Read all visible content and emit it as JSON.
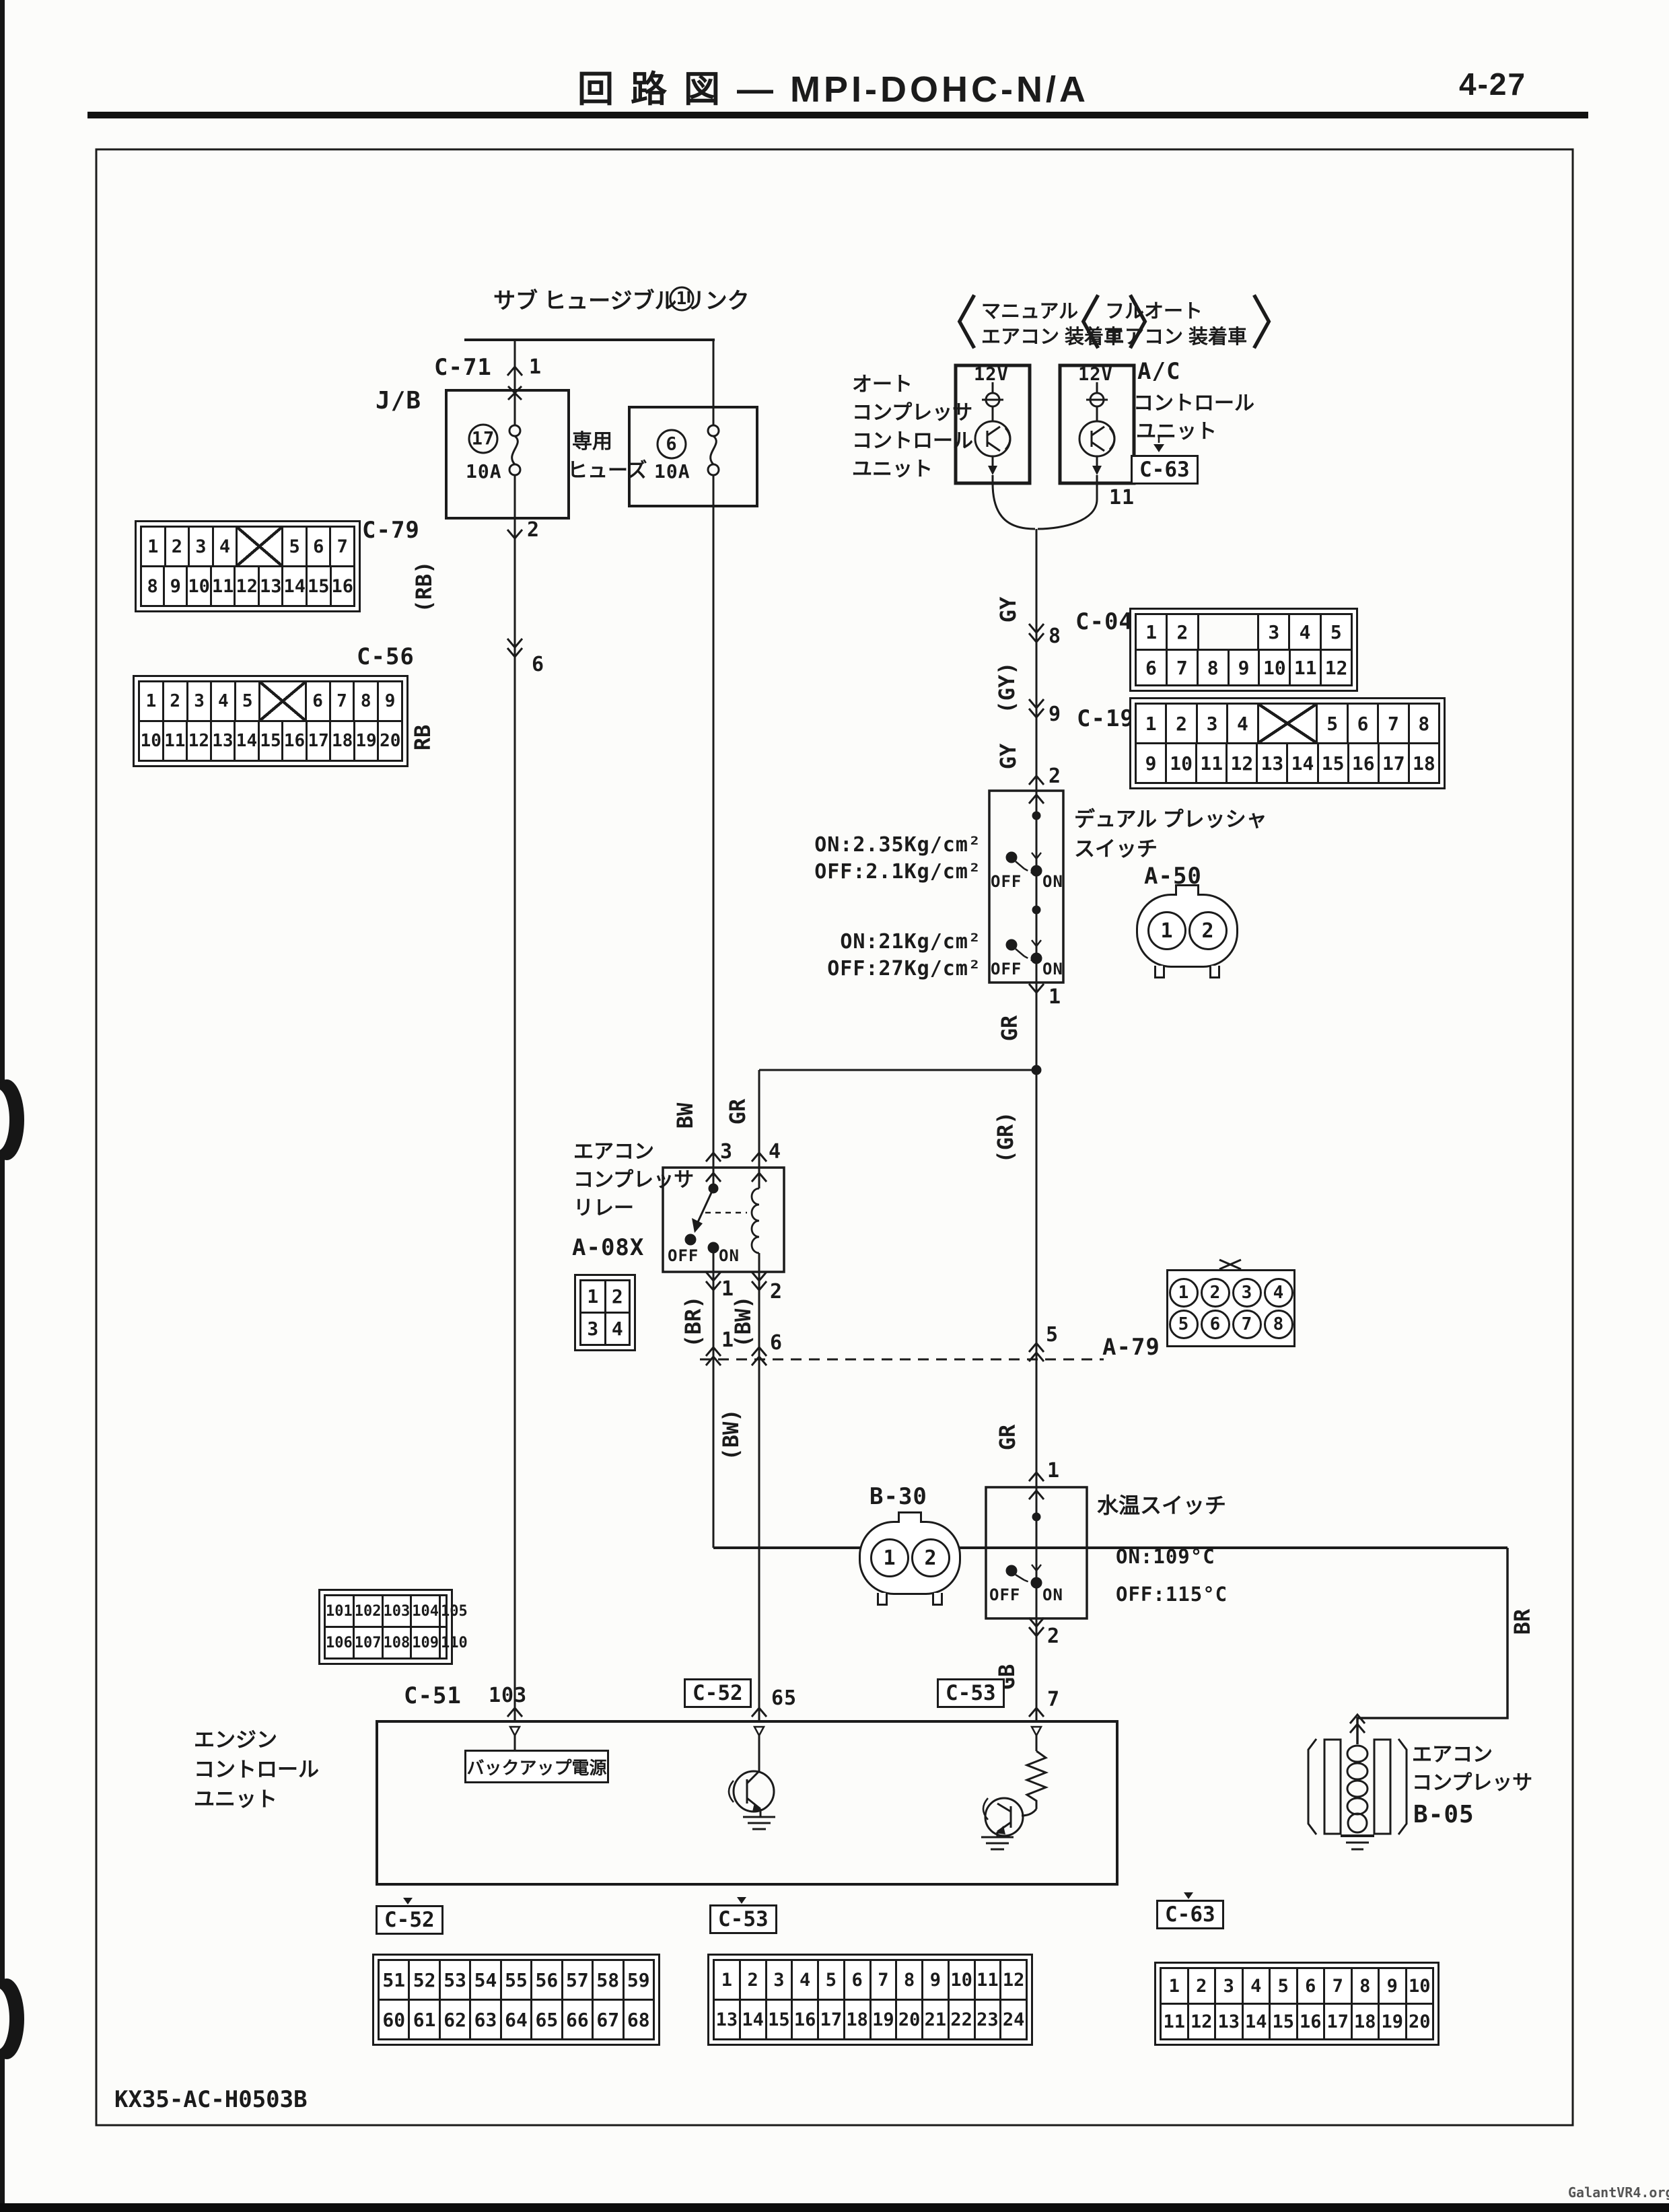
{
  "page": {
    "title": "回 路 図 — MPI-DOHC-N/A",
    "page_no": "4-27",
    "doc_code": "KX35-AC-H0503B",
    "watermark": "GalantVR4.org"
  },
  "power": {
    "fusible_link": "サブ ヒュージブル リンク",
    "link_no": "1",
    "jb": "J/B",
    "c71": "C-71",
    "c71_pin": "1",
    "fuse1_no": "17",
    "fuse1_amp": "10A",
    "dedicated_fuse_1": "専用",
    "dedicated_fuse_2": "ヒューズ",
    "fuse2_no": "6",
    "fuse2_amp": "10A",
    "c79": "C-79",
    "c79_pin": "2",
    "c56": "C-56",
    "c56_pin": "6"
  },
  "units": {
    "manual_tag_1": "マニュアル",
    "manual_tag_2": "エアコン 装着車",
    "auto_tag_1": "フルオート",
    "auto_tag_2": "エアコン 装着車",
    "v12_left": "12V",
    "v12_right": "12V",
    "left_name_1": "オート",
    "left_name_2": "コンプレッサ",
    "left_name_3": "コントロール",
    "left_name_4": "ユニット",
    "right_name_1": "A/C",
    "right_name_2": "コントロール",
    "right_name_3": "ユニット",
    "c63_top": "C-63",
    "pin11": "11"
  },
  "pressure_switch": {
    "name_1": "デュアル プレッシャ",
    "name_2": "スイッチ",
    "conn": "A-50",
    "hi_on": "ON:2.35Kg/cm²",
    "hi_off": "OFF:2.1Kg/cm²",
    "lo_on": "ON:21Kg/cm²",
    "lo_off": "OFF:27Kg/cm²",
    "sw1_off": "OFF",
    "sw1_on": "ON",
    "sw2_off": "OFF",
    "sw2_on": "ON",
    "pin_in": "2",
    "pin_out": "1"
  },
  "relay": {
    "name_1": "エアコン",
    "name_2": "コンプレッサ",
    "name_3": "リレー",
    "conn": "A-08X",
    "off": "OFF",
    "on": "ON",
    "pin3": "3",
    "pin4": "4",
    "pin1": "1",
    "pin2": "2"
  },
  "a79": {
    "label": "A-79",
    "pin1": "1",
    "pin6": "6",
    "pin5": "5"
  },
  "water_switch": {
    "conn": "B-30",
    "name": "水温スイッチ",
    "on_temp": "ON:109°C",
    "off_temp": "OFF:115°C",
    "sw_off": "OFF",
    "sw_on": "ON",
    "pin_in": "1",
    "pin_out": "2"
  },
  "ecu": {
    "name_1": "エンジン",
    "name_2": "コントロール",
    "name_3": "ユニット",
    "backup": "バックアップ電源",
    "c51": "C-51",
    "pin103": "103",
    "pin65": "65",
    "pin7": "7"
  },
  "compressor": {
    "name_1": "エアコン",
    "name_2": "コンプレッサ",
    "conn": "B-05"
  },
  "wires": {
    "rb_p": "(RB)",
    "rb": "RB",
    "bw": "BW",
    "gr_relay": "GR",
    "gy1": "GY",
    "gy_pin8": "8",
    "gy_p": "(GY)",
    "gy_pin9": "9",
    "gy2": "GY",
    "gr1": "GR",
    "gr_p": "(GR)",
    "br_p": "(BR)",
    "bw_p": "(BW)",
    "bw_p2": "(BW)",
    "gr2": "GR",
    "gb": "GB",
    "br": "BR"
  },
  "connectors": {
    "c79": {
      "label": "C-79",
      "rows": [
        [
          "1",
          "2",
          "3",
          "4",
          "X",
          "5",
          "6",
          "7"
        ],
        [
          "8",
          "9",
          "10",
          "11",
          "12",
          "13",
          "14",
          "15",
          "16"
        ]
      ]
    },
    "c56": {
      "label": "C-56",
      "rows": [
        [
          "1",
          "2",
          "3",
          "4",
          "5",
          "X",
          "6",
          "7",
          "8",
          "9"
        ],
        [
          "10",
          "11",
          "12",
          "13",
          "14",
          "15",
          "16",
          "17",
          "18",
          "19",
          "20"
        ]
      ]
    },
    "c04": {
      "label": "C-04",
      "rows": [
        [
          "1",
          "2",
          "GAP",
          "3",
          "4",
          "5"
        ],
        [
          "6",
          "7",
          "8",
          "9",
          "10",
          "11",
          "12"
        ]
      ]
    },
    "c19": {
      "label": "C-19",
      "rows": [
        [
          "1",
          "2",
          "3",
          "4",
          "X",
          "5",
          "6",
          "7",
          "8"
        ],
        [
          "9",
          "10",
          "11",
          "12",
          "13",
          "14",
          "15",
          "16",
          "17",
          "18"
        ]
      ]
    },
    "c51": {
      "label": "C-51",
      "rows": [
        [
          "101",
          "102",
          "103",
          "104",
          "105"
        ],
        [
          "106",
          "107",
          "108",
          "109",
          "110"
        ]
      ]
    },
    "a08x": {
      "label": "A-08X",
      "rows": [
        [
          "1",
          "2"
        ],
        [
          "3",
          "4"
        ]
      ]
    },
    "a79c": {
      "label": "A-79",
      "rows": [
        [
          "1",
          "2",
          "3",
          "4"
        ],
        [
          "5",
          "6",
          "7",
          "8"
        ]
      ]
    },
    "a50c": {
      "label": "A-50",
      "rows": [
        [
          "1",
          "2"
        ]
      ]
    },
    "b30c": {
      "label": "B-30",
      "rows": [
        [
          "1",
          "2"
        ]
      ]
    },
    "c52b": {
      "label": "C-52",
      "rows": [
        [
          "51",
          "52",
          "53",
          "54",
          "55",
          "56",
          "57",
          "58",
          "59"
        ],
        [
          "60",
          "61",
          "62",
          "63",
          "64",
          "65",
          "66",
          "67",
          "68"
        ]
      ]
    },
    "c53b": {
      "label": "C-53",
      "rows": [
        [
          "1",
          "2",
          "3",
          "4",
          "5",
          "6",
          "7",
          "8",
          "9",
          "10",
          "11",
          "12"
        ],
        [
          "13",
          "14",
          "15",
          "16",
          "17",
          "18",
          "19",
          "20",
          "21",
          "22",
          "23",
          "24"
        ]
      ]
    },
    "c63b": {
      "label": "C-63",
      "rows": [
        [
          "1",
          "2",
          "3",
          "4",
          "5",
          "6",
          "7",
          "8",
          "9",
          "10"
        ],
        [
          "11",
          "12",
          "13",
          "14",
          "15",
          "16",
          "17",
          "18",
          "19",
          "20"
        ]
      ]
    }
  }
}
